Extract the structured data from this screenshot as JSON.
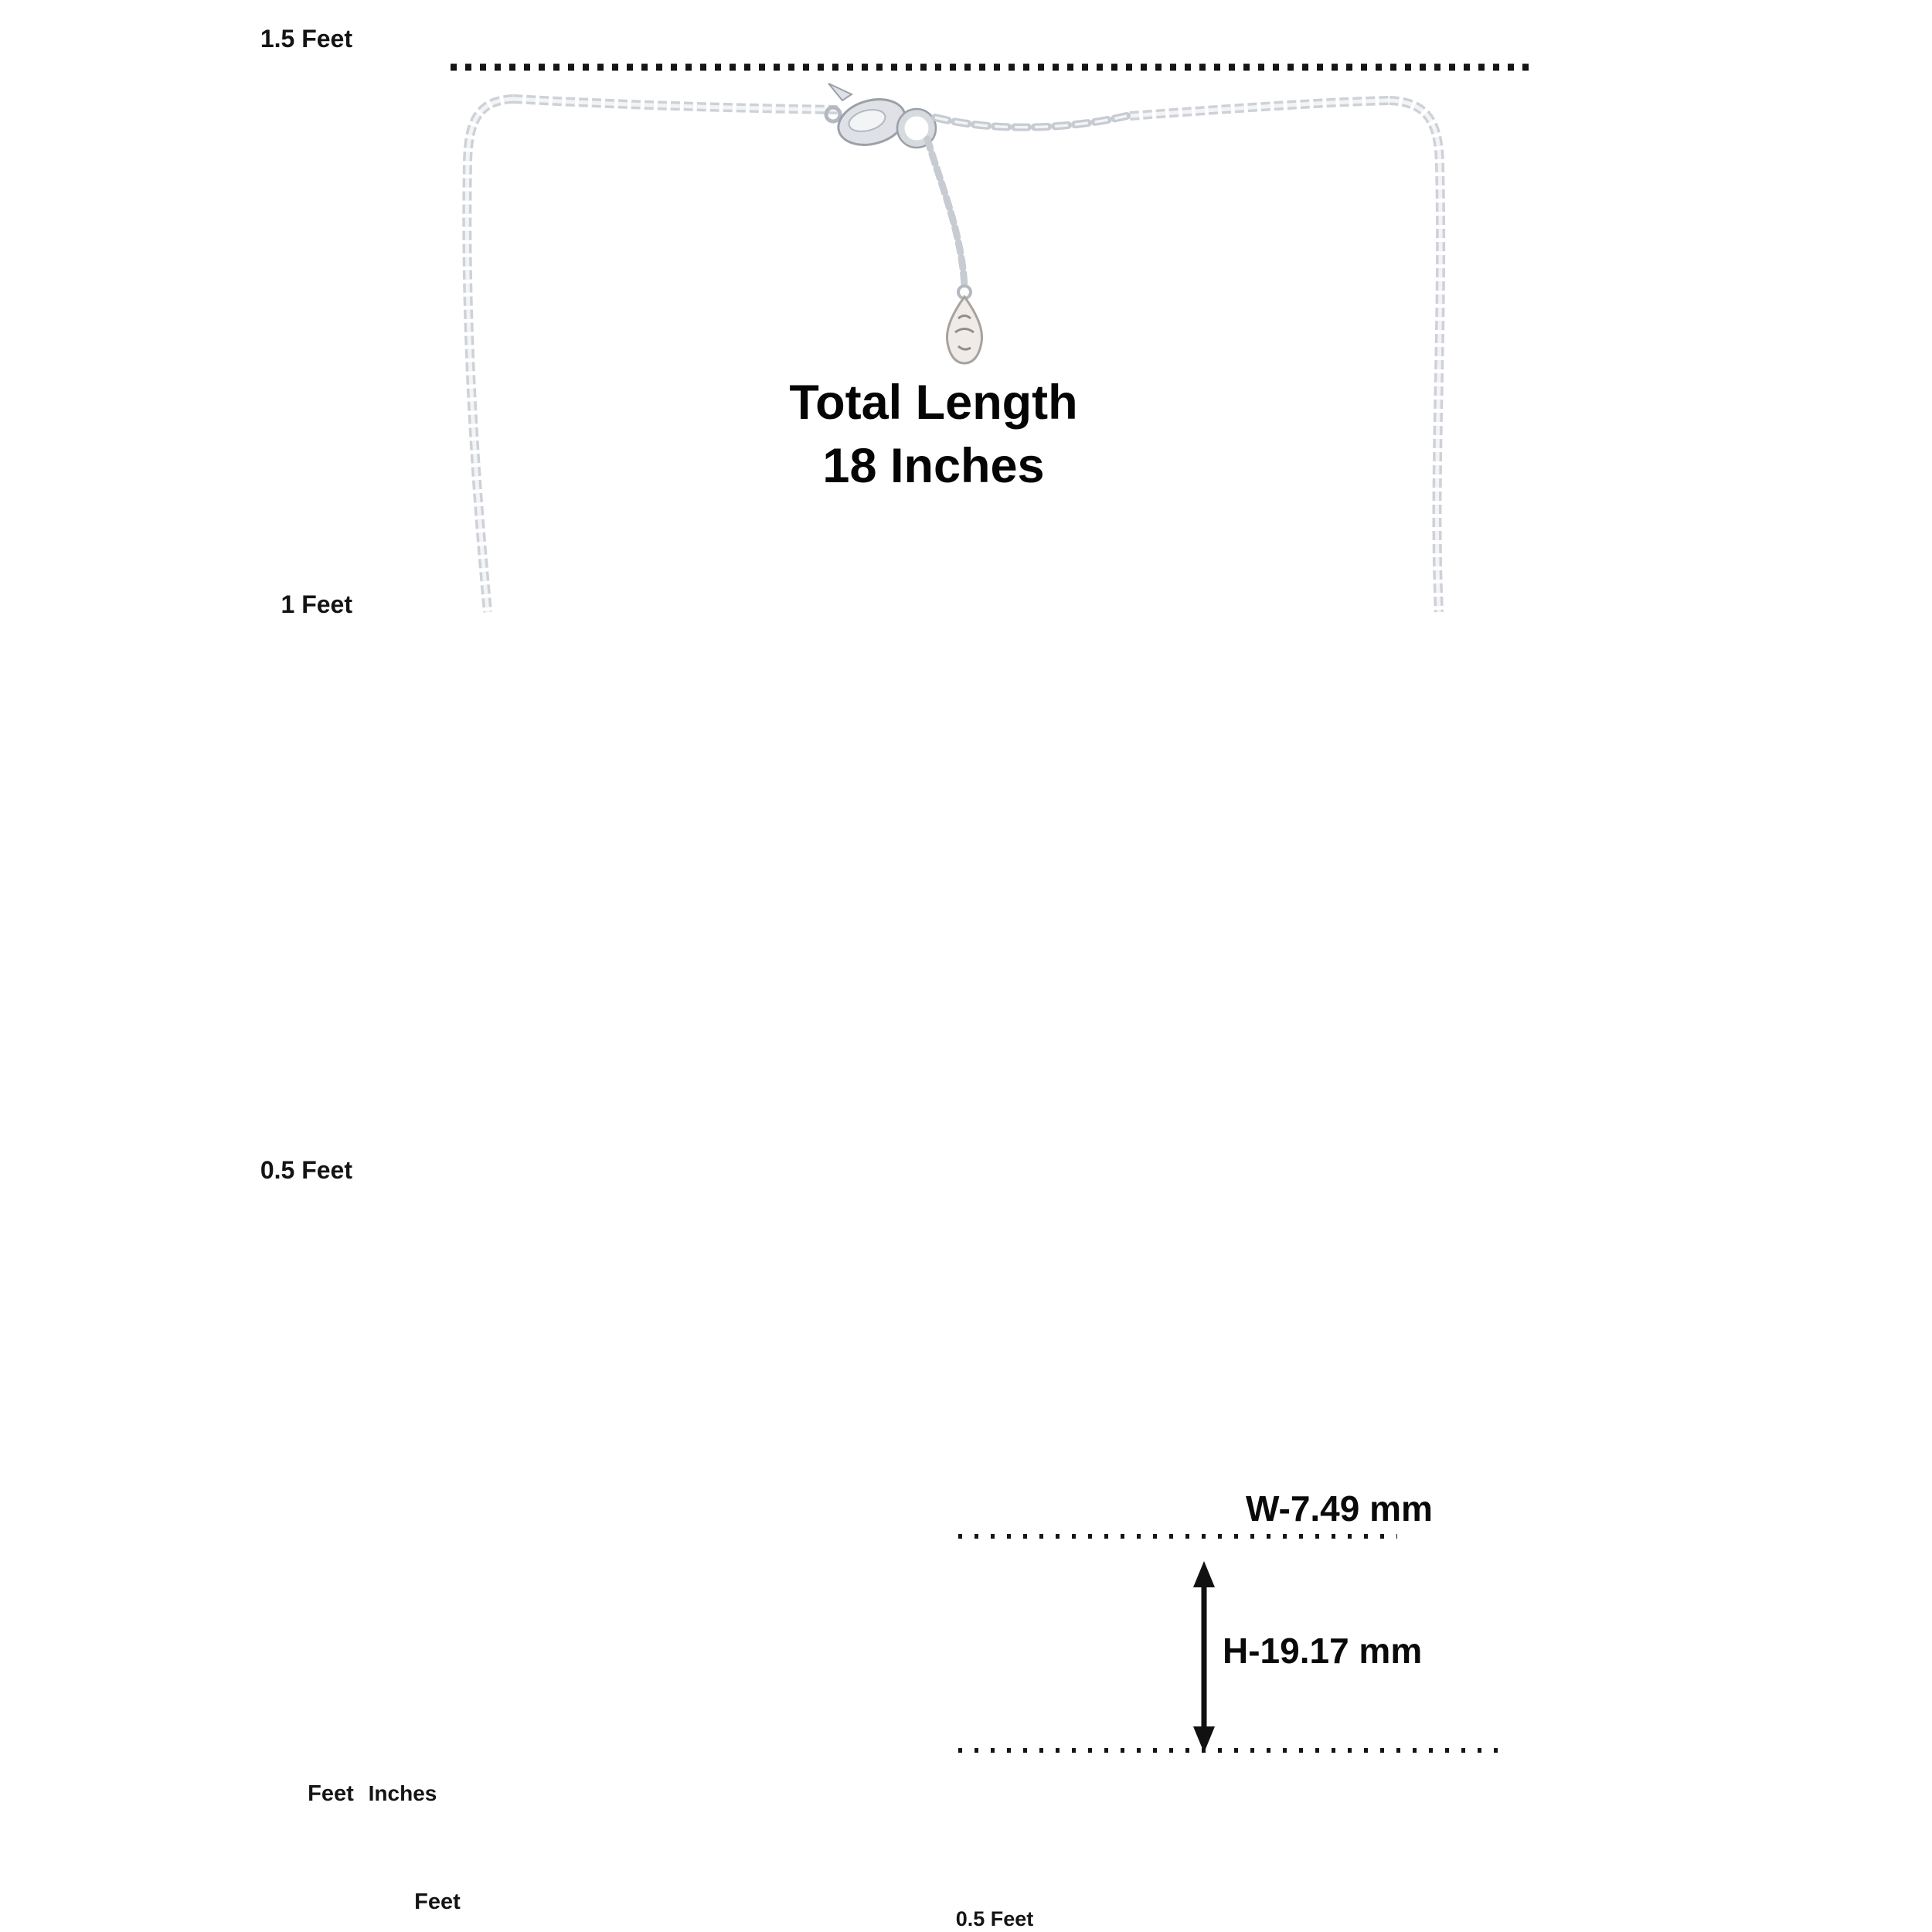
{
  "figure": {
    "title_line1": "Total Length",
    "title_line2": "18 Inches",
    "width_label": "W-7.49 mm",
    "height_label": "H-19.17 mm",
    "total_length_inches": 18
  },
  "vertical_ruler_feet": {
    "unit_label": "Feet",
    "inch_numbers": [
      0,
      1,
      2,
      3,
      4,
      5,
      6,
      7,
      8,
      9,
      10,
      11,
      12,
      13,
      14,
      15,
      16,
      17,
      18
    ],
    "feet_marks": [
      {
        "label": "1.5 Feet",
        "inches": 18
      },
      {
        "label": "1 Feet",
        "inches": 12
      },
      {
        "label": "0.5 Feet",
        "inches": 6
      }
    ]
  },
  "vertical_ruler_inches": {
    "unit_label": "Inches",
    "inch_numbers": [
      0,
      1,
      2,
      3,
      4,
      5,
      6,
      7,
      8,
      9,
      10,
      11,
      12,
      13,
      14,
      15,
      16,
      17,
      18
    ]
  },
  "horizontal_ruler_top": {
    "inch_numbers": [
      0,
      1,
      2,
      3,
      4,
      5,
      6,
      7,
      8,
      9,
      10,
      11
    ]
  },
  "horizontal_ruler_bottom": {
    "unit_label": "Feet",
    "inch_numbers": [
      0,
      1,
      2,
      3,
      4,
      5,
      6,
      7,
      8,
      9,
      10,
      11
    ],
    "half_foot_mark": {
      "label": "0.5 Feet",
      "inches": 6
    }
  },
  "necklace": {
    "clusters_per_side": 11,
    "colors": {
      "metal": "#c6cad1",
      "metal_dark": "#9ba0a9",
      "metal_mid": "#ced2d8",
      "metal_light": "#f3f4f6",
      "pave_ring": "#b6bbc3",
      "pave_sparkle": "#eef0f3",
      "plate_fill": "#f7f8fa",
      "tag_fill": "#eeebe9",
      "tag_stroke": "#a9a29c"
    }
  },
  "annotation": {
    "ink": "#141414",
    "dotted_line_18in": true,
    "width_dotted_line": true,
    "height_arrow": true
  }
}
